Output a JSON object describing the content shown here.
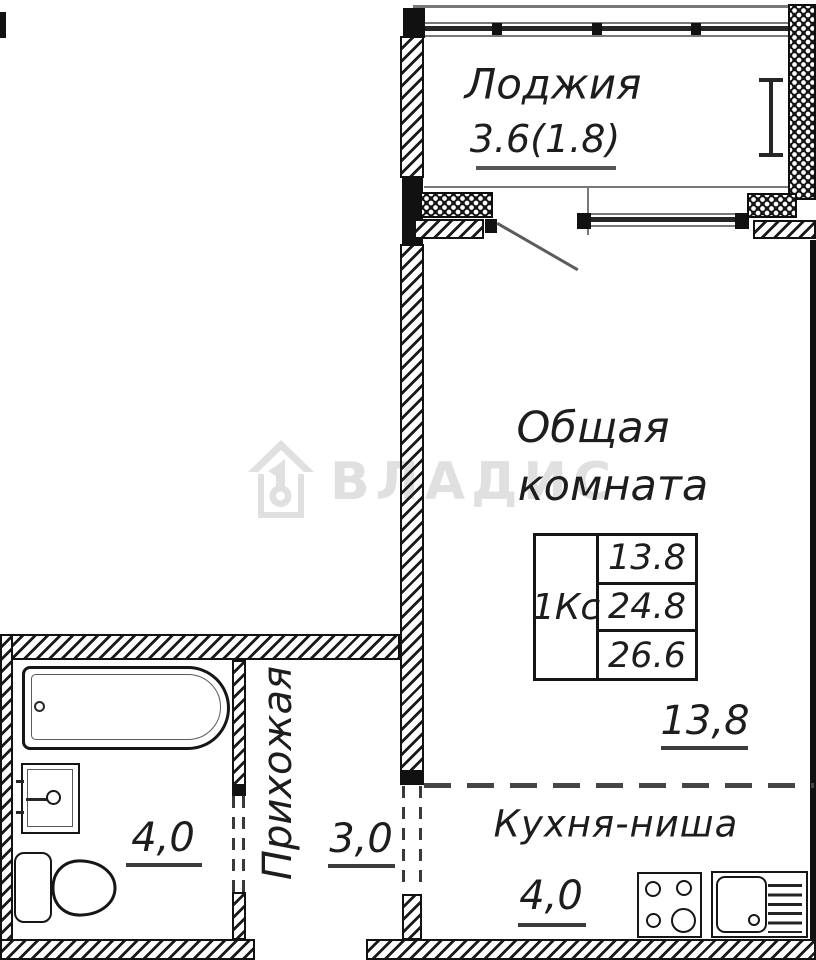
{
  "watermark": {
    "brand": "ВЛАДИС",
    "logo": "house-keyhole-icon"
  },
  "rooms": {
    "loggia": {
      "name": "Лоджия",
      "area": "3.6(1.8)"
    },
    "living": {
      "name_line1": "Общая",
      "name_line2": "комната",
      "dim": "13,8"
    },
    "kitchen": {
      "name": "Кухня-ниша",
      "dim": "4,0"
    },
    "hallway": {
      "name": "Прихожая",
      "dim": "3,0"
    },
    "bathroom": {
      "dim": "4,0"
    }
  },
  "stamp": {
    "apartment_type": "1Кс",
    "rows": [
      "13.8",
      "24.8",
      "26.6"
    ]
  },
  "colors": {
    "line": "#1a1a1a",
    "thin_line": "#787878",
    "dashed_line": "#454545",
    "watermark": "#e0e0e0",
    "background": "#ffffff"
  }
}
